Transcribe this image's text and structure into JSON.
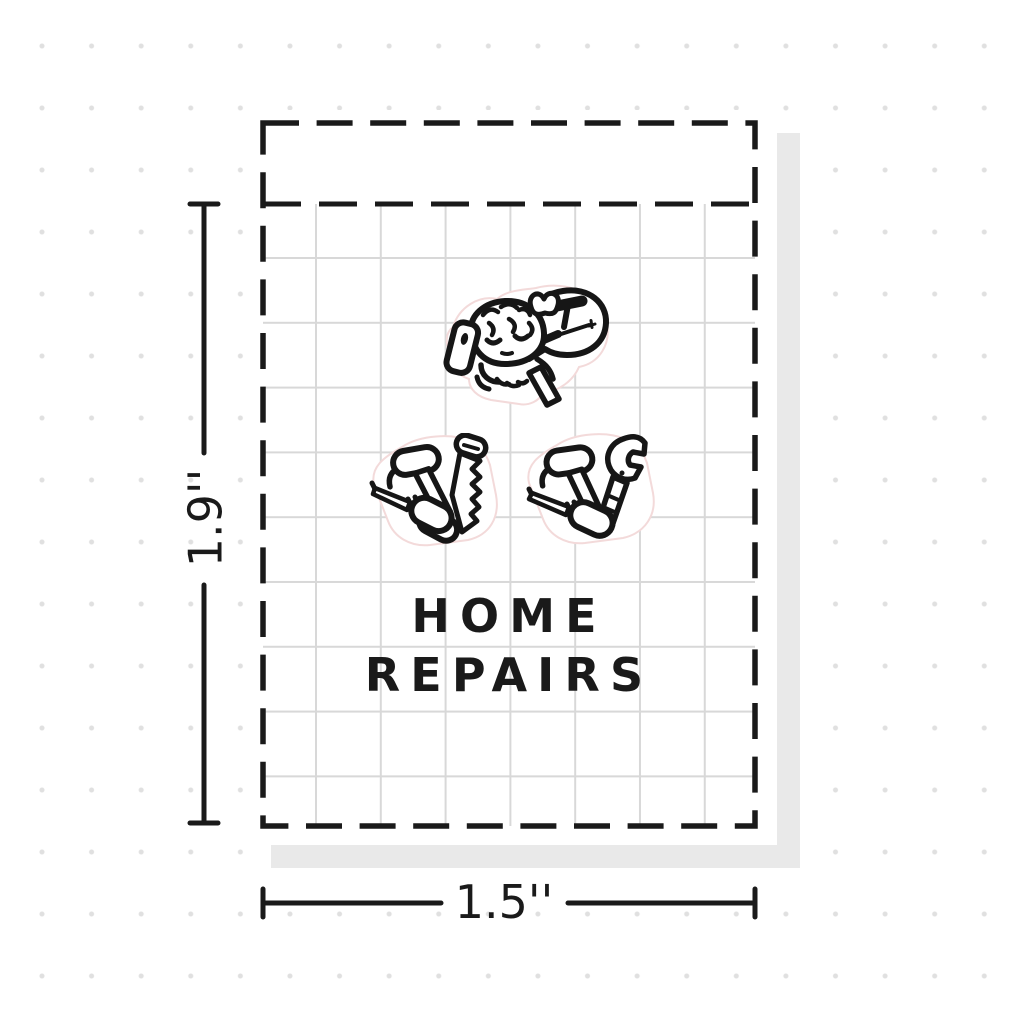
{
  "sheet": {
    "title_line1": "HOME",
    "title_line2": "REPAIRS",
    "stickers": [
      {
        "name": "girl-on-phone-idea-bubble-sticker"
      },
      {
        "name": "hammer-saw-screwdriver-sticker"
      },
      {
        "name": "hammer-wrench-screwdriver-sticker"
      }
    ]
  },
  "measurements": {
    "height_label": "1.9''",
    "width_label": "1.5''"
  },
  "colors": {
    "ink": "#1a1a1a",
    "shadow": "#e9e9e9",
    "grid_line": "#d8d8d8",
    "background_dot": "#e0e0e0",
    "diecut_outline": "#f3dada"
  }
}
